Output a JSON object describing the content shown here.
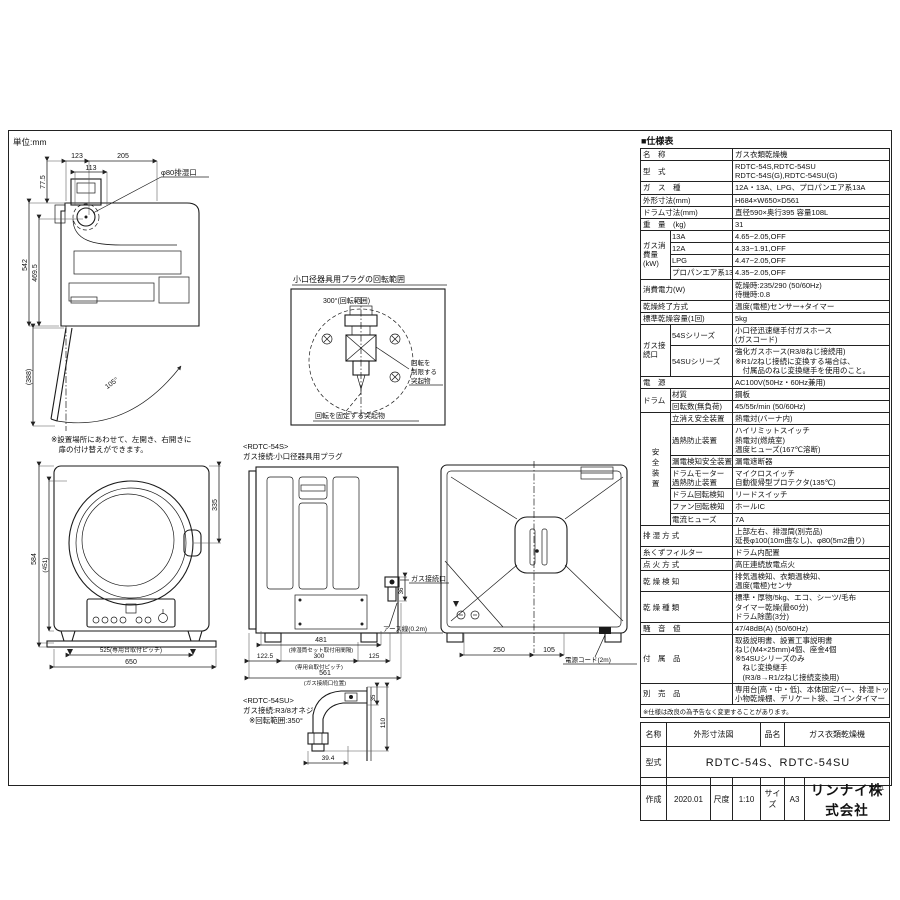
{
  "drawings": {
    "unit_note": "単位:mm",
    "page_mark": "1/1",
    "side_view": {
      "dim_123": "123",
      "dim_205": "205",
      "dim_113": "113",
      "dim_77_5": "77.5",
      "dim_542": "542",
      "dim_469_5": "469.5",
      "dim_388": "(388)",
      "door_angle": "105°",
      "exhaust_port_label": "φ80排湿口",
      "note_line1": "※設置場所にあわせて、左開き、右開きに",
      "note_line2": "　扉の付け替えができます。"
    },
    "plug_rotation": {
      "title": "小口径器具用プラグの回転範囲",
      "range_label": "300°(回転範囲)",
      "limit_line1": "回転を",
      "limit_line2": "制限する",
      "limit_line3": "突起物",
      "fix_label": "回転を固定する突起物"
    },
    "front_view": {
      "dim_584": "584",
      "dim_451": "(451)",
      "dim_335": "335",
      "dim_525": "525(専用台取付ピッチ)",
      "dim_650": "650"
    },
    "rear_gas_view": {
      "model": "<RDTC-54S>",
      "subtitle": "ガス接続:小口径器具用プラグ",
      "dim_481": "481",
      "dim_481_note": "(排湿筒セット取付用間隔)",
      "dim_122_5": "122.5",
      "dim_300": "300",
      "dim_300_note": "(専用台取付ピッチ)",
      "dim_125": "125",
      "dim_561": "561",
      "dim_561_note": "(ガス接続口位置)",
      "dim_36": "36",
      "gas_port_label": "ガス接続口",
      "earth_label": "アース線(0.2m)"
    },
    "back_view": {
      "dim_250": "250",
      "dim_105": "105",
      "cord_label": "電源コード(2m)"
    },
    "fitting_view": {
      "model": "<RDTC-54SU>",
      "subtitle": "ガス接続:R3/8オネジ",
      "rotation_note": "※回転範囲:350°",
      "dim_39_4": "39.4",
      "dim_110": "110",
      "dim_35": "35"
    }
  },
  "spec": {
    "title": "■仕様表",
    "rows": {
      "name": {
        "label": "名　称",
        "value": "ガス衣類乾燥機"
      },
      "model": {
        "label": "型　式",
        "value1": "RDTC-54S,RDTC-54SU",
        "value2": "RDTC-54S(G),RDTC-54SU(G)"
      },
      "gas_type": {
        "label": "ガ　ス　種",
        "value": "12A・13A、LPG、プロパンエア系13A"
      },
      "dimensions": {
        "label": "外形寸法(mm)",
        "value": "H684×W650×D561"
      },
      "drum_dim": {
        "label": "ドラム寸法(mm)",
        "value": "直径590×奥行395 容量108L"
      },
      "weight": {
        "label": "重　量　(kg)",
        "value": "31"
      },
      "gas_consumption": {
        "label": "ガス消費量(kW)",
        "r13a_label": "13A",
        "r13a": "4.65~2.05,OFF",
        "r12a_label": "12A",
        "r12a": "4.33~1.91,OFF",
        "lpg_label": "LPG",
        "lpg": "4.47~2.05,OFF",
        "pa_label": "プロパンエア系13A",
        "pa": "4.35~2.05,OFF"
      },
      "power": {
        "label": "消費電力(W)",
        "value1": "乾燥時:235/290 (50/60Hz)",
        "value2": "待機時:0.8"
      },
      "dry_end": {
        "label": "乾燥終了方式",
        "value": "温度(電極)センサー+タイマー"
      },
      "capacity": {
        "label": "標準乾燥容量(1回)",
        "value": "5kg"
      },
      "gas_connection": {
        "label": "ガス接続口",
        "s54_label": "54Sシリーズ",
        "s54_v1": "小口径迅速継手付ガスホース",
        "s54_v2": "(ガスコード)",
        "su54_label": "54SUシリーズ",
        "su54_v1": "強化ガスホース(R3/8ねじ接続用)",
        "su54_v2": "※R1/2ねじ接続に変換する場合は、",
        "su54_v3": "　付属品のねじ変換継手を使用のこと。"
      },
      "power_supply": {
        "label": "電　源",
        "value": "AC100V(50Hz・60Hz兼用)"
      },
      "drum": {
        "label": "ドラム",
        "material_label": "材質",
        "material_value": "鋼板",
        "speed_label": "回転数(無負荷)",
        "speed_value": "45/55r/min (50/60Hz)"
      },
      "safety": {
        "label": "安全装置",
        "flame_label": "立消え安全装置",
        "flame_value": "熱電対(バーナ内)",
        "overheat_label": "過熱防止装置",
        "overheat_v1": "ハイリミットスイッチ",
        "overheat_v2": "熱電対(燃焼室)",
        "overheat_v3": "温度ヒューズ(167℃溶断)",
        "leak_label": "漏電検知安全装置",
        "leak_value": "漏電遮断器",
        "motor_label1": "ドラムモーター",
        "motor_label2": "過熱防止装置",
        "motor_v1": "マイクロスイッチ",
        "motor_v2": "自動復帰型プロテクタ(135℃)",
        "drum_rot_label": "ドラム回転検知",
        "drum_rot_value": "リードスイッチ",
        "fan_rot_label": "ファン回転検知",
        "fan_rot_value": "ホールIC",
        "fuse_label": "電流ヒューズ",
        "fuse_value": "7A"
      },
      "exhaust": {
        "label": "排 湿 方 式",
        "value1": "上部左右、排湿筒(別売品)",
        "value2": "延長φ100(10m曲なし)、φ80(5m2曲り)"
      },
      "filter": {
        "label": "糸くずフィルター",
        "value": "ドラム内配置"
      },
      "ignition": {
        "label": "点 火 方 式",
        "value": "高圧連続放電点火"
      },
      "detect": {
        "label": "乾 燥 検 知",
        "value1": "排気温検知、衣類温検知、",
        "value2": "温度(電極)センサ"
      },
      "modes": {
        "label": "乾 燥 種 類",
        "value1": "標準・厚物/5kg、エコ、シーツ/毛布",
        "value2": "タイマー乾燥(最60分)",
        "value3": "ドラム除菌(3分)"
      },
      "noise": {
        "label": "騒　音　値",
        "value": "47/48dB(A) (50/60Hz)"
      },
      "accessories": {
        "label": "付　属　品",
        "v1": "取扱説明書、設置工事説明書",
        "v2": "ねじ(M4×25mm)4個、座金4個",
        "v3": "※54SUシリーズのみ",
        "v4": "　ねじ変換継手",
        "v5": "　(R3/8→R1/2ねじ接続変換用)"
      },
      "optional": {
        "label": "別　売　品",
        "v1": "専用台[高・中・低]、本体固定バー、排湿トップ",
        "v2": "小物乾燥棚、デリケート袋、コインタイマー"
      }
    },
    "note": "※仕様は改良の為予告なく変更することがあります。"
  },
  "title_block": {
    "name_label": "名称",
    "name_value": "外形寸法図",
    "item_label": "品名",
    "item_value": "ガス衣類乾燥機",
    "model_label": "型式",
    "model_value": "RDTC-54S、RDTC-54SU",
    "created_label": "作成",
    "created_value": "2020.01",
    "scale_label": "尺度",
    "scale_value": "1:10",
    "size_label": "サイズ",
    "size_value": "A3",
    "company": "リンナイ株式会社"
  }
}
